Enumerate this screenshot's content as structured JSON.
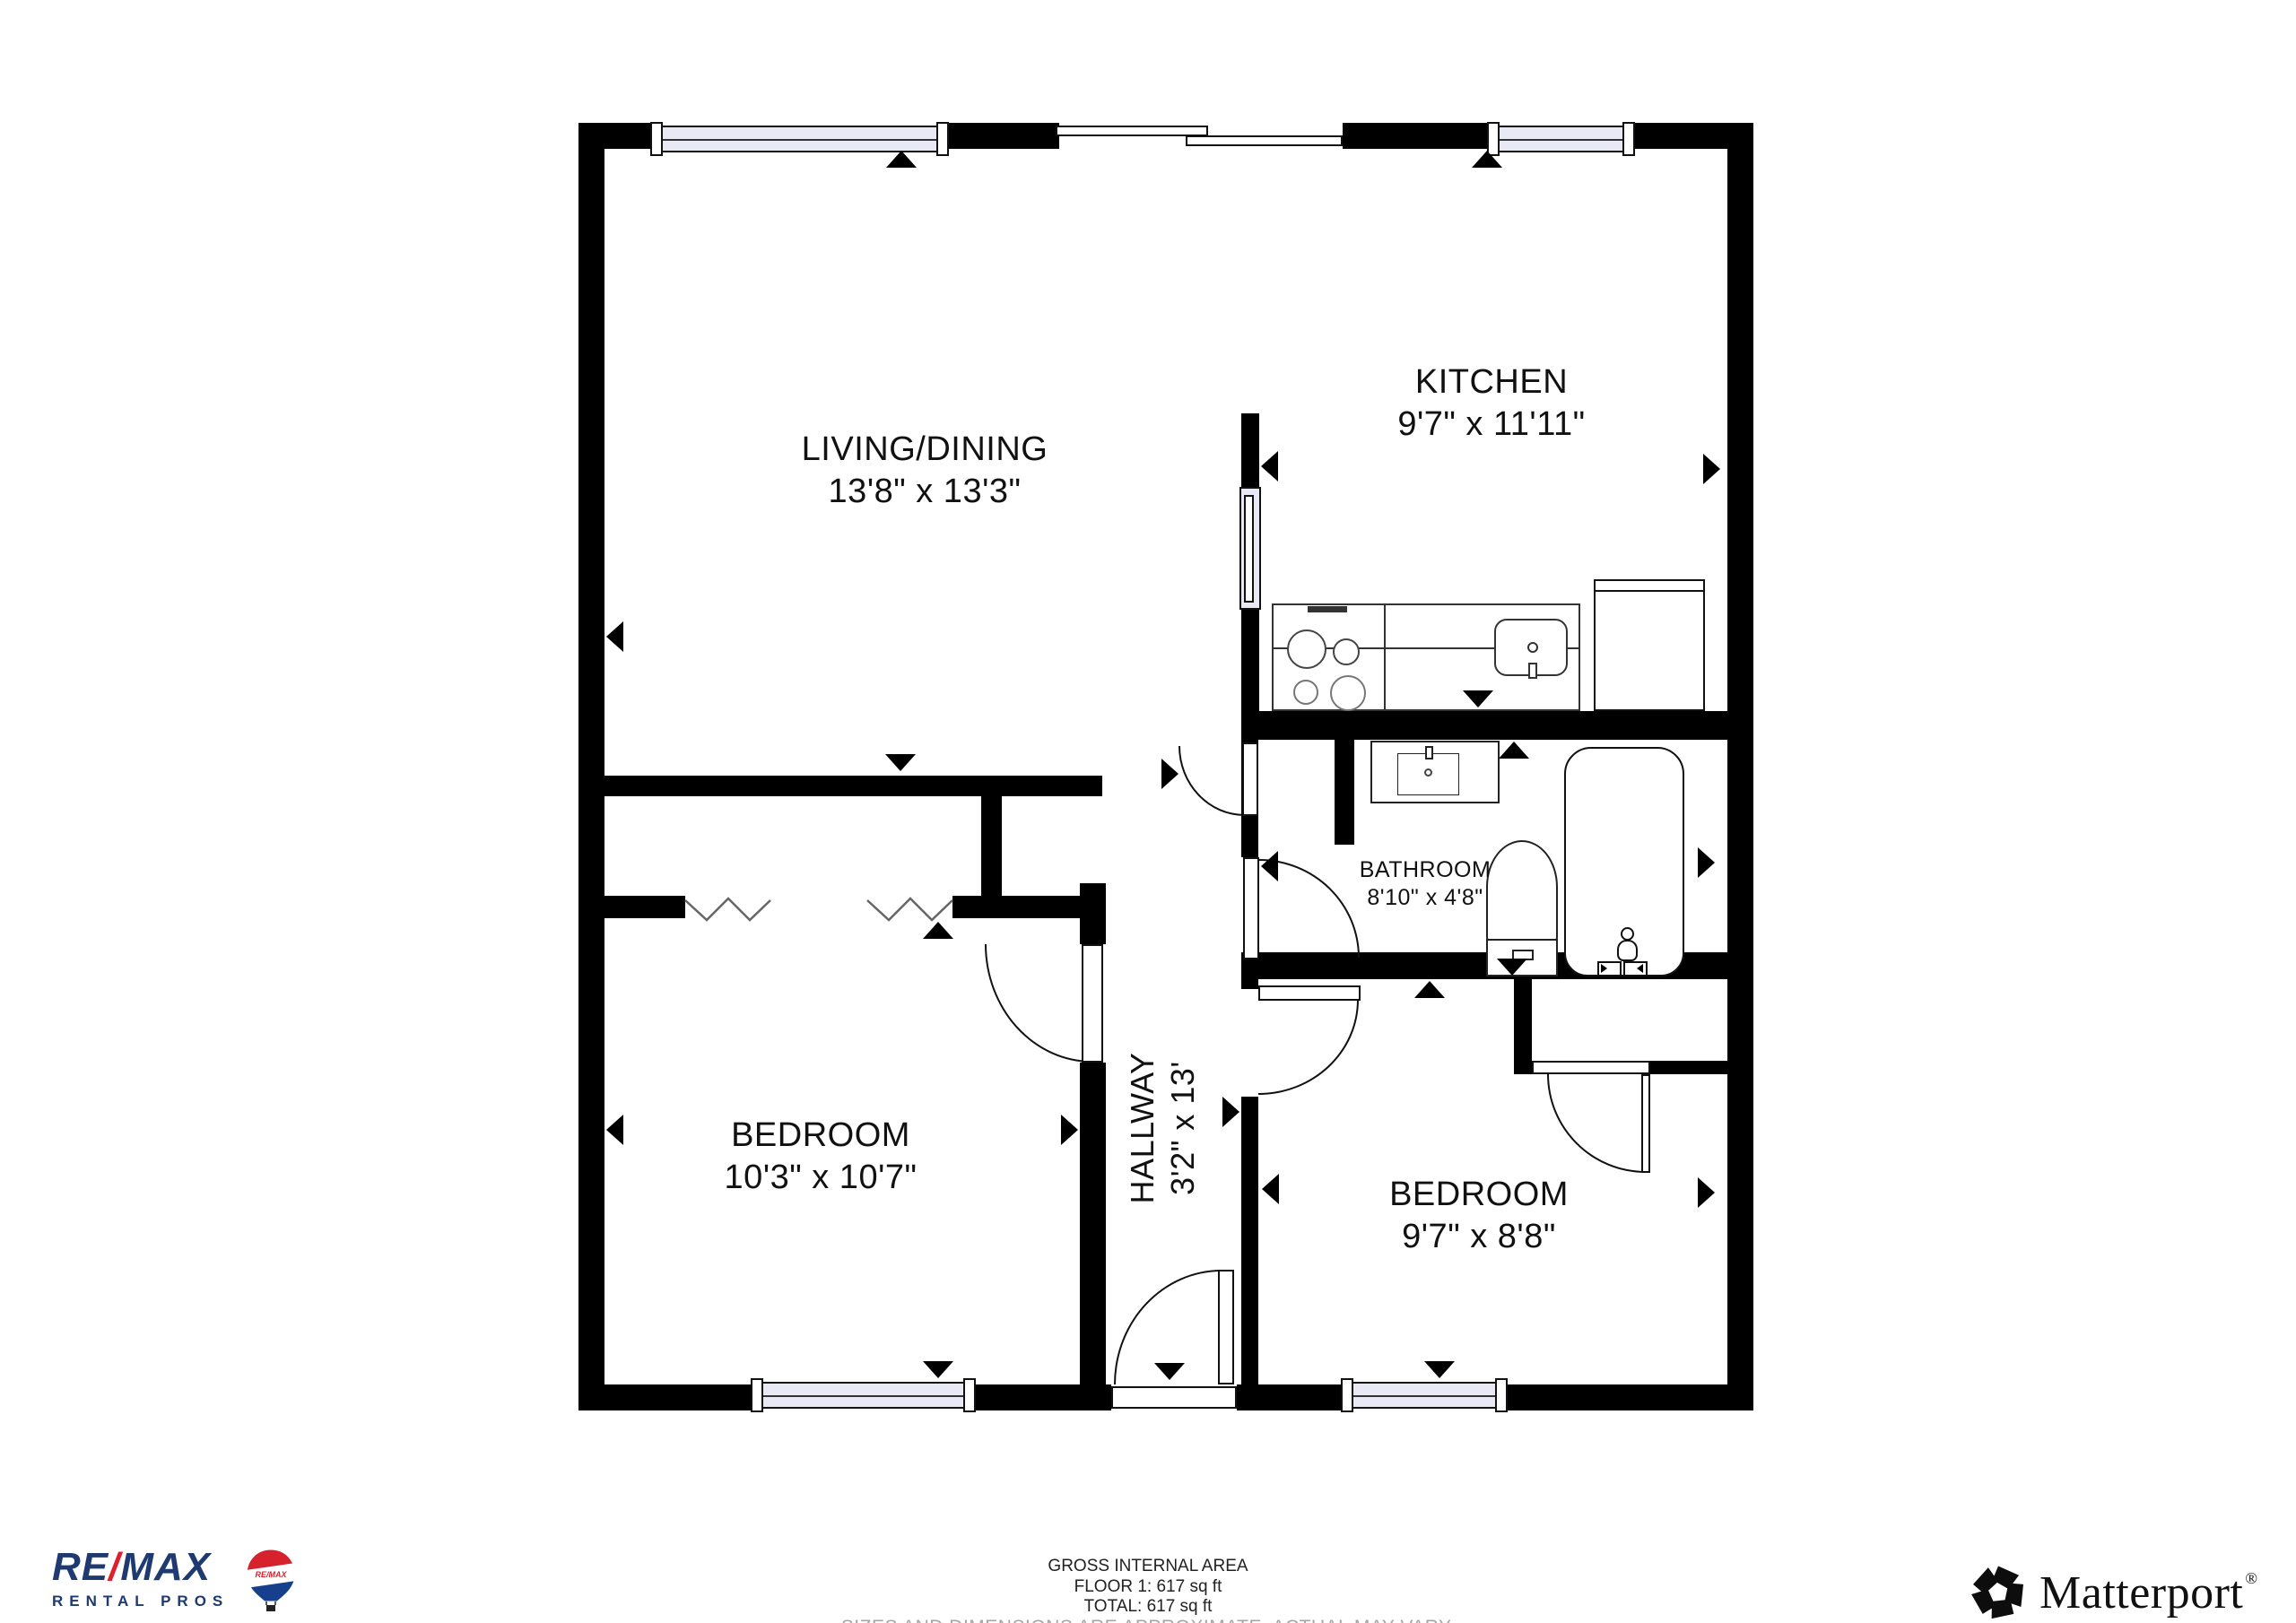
{
  "rooms": {
    "living": {
      "name": "LIVING/DINING",
      "dims": "13'8\" x 13'3\""
    },
    "kitchen": {
      "name": "KITCHEN",
      "dims": "9'7\" x 11'11\""
    },
    "bathroom": {
      "name": "BATHROOM",
      "dims": "8'10\" x 4'8\""
    },
    "bedroom_left": {
      "name": "BEDROOM",
      "dims": "10'3\" x 10'7\""
    },
    "hallway": {
      "name": "HALLWAY",
      "dims": "3'2\" x 13'"
    },
    "bedroom_right": {
      "name": "BEDROOM",
      "dims": "9'7\" x 8'8\""
    }
  },
  "footer": {
    "gross": "GROSS INTERNAL AREA",
    "floor": "FLOOR 1: 617 sq ft",
    "total": "TOTAL: 617 sq ft",
    "disclaimer": "SIZES AND DIMENSIONS ARE APPROXIMATE, ACTUAL MAY VARY."
  },
  "remax": {
    "re": "RE",
    "slash": "/",
    "max": "MAX",
    "tagline": "RENTAL PROS",
    "balloon_text": "RE/MAX",
    "navy": "#1e3a70",
    "red": "#e01f2d"
  },
  "matterport": {
    "name": "Matterport",
    "reg": "®"
  },
  "colors": {
    "wall": "#000000",
    "window_glass": "#e9e9f6",
    "background": "#ffffff"
  }
}
